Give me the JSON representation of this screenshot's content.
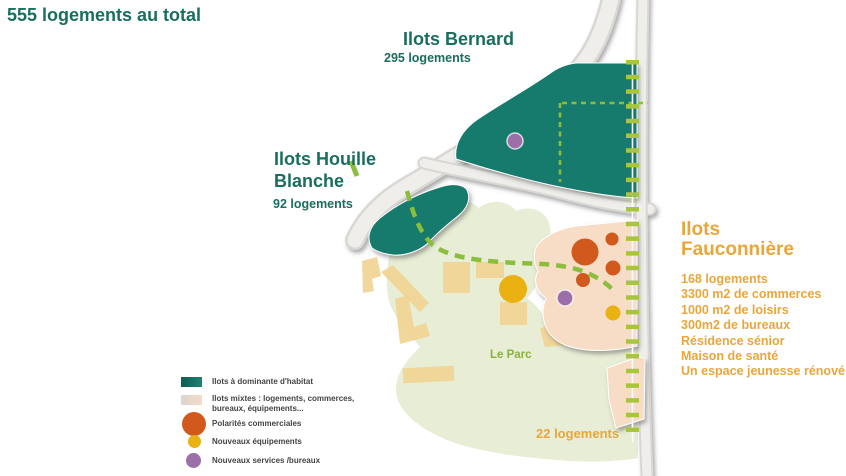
{
  "title": "555 logements au total",
  "zones": {
    "bernard": {
      "name": "Ilots Bernard",
      "count": "295 logements"
    },
    "houille": {
      "name": "Ilots Houille Blanche",
      "count": "92 logements"
    },
    "fauconniere": {
      "name": "Ilots Fauconnière",
      "details": [
        "168 logements",
        "3300 m2 de commerces",
        "1000 m2 de loisirs",
        "300m2 de bureaux",
        "Résidence sénior",
        "Maison de santé",
        "Un espace jeunesse rénové"
      ]
    },
    "south": {
      "count": "22 logements"
    },
    "parc": {
      "name": "Le Parc"
    }
  },
  "legend": {
    "items": [
      {
        "key": "habitat",
        "label": "Ilots à dominante d'habitat"
      },
      {
        "key": "mixte",
        "label": "Ilots mixtes : logements, commerces, bureaux, équipements..."
      },
      {
        "key": "commercial",
        "label": "Polarités commerciales"
      },
      {
        "key": "equipements",
        "label": "Nouveaux équipements"
      },
      {
        "key": "services",
        "label": "Nouveaux services /bureaux"
      }
    ]
  },
  "colors": {
    "teal": "#177a6c",
    "teal_text": "#1a6e60",
    "peach": "#f7dcc6",
    "orange_circle": "#d2591d",
    "yellow_circle": "#eab112",
    "purple_circle": "#9c6fa8",
    "building_tan": "#f0d494",
    "park_green": "#e8edd5",
    "road_gray": "#efeeeb",
    "road_edge": "#d8d7d3",
    "dash_green": "#8cbd3d",
    "ladder_green": "#a9c43e",
    "orange_text": "#e9a63d",
    "parc_text": "#8ab13e",
    "legend_text": "#444444"
  }
}
